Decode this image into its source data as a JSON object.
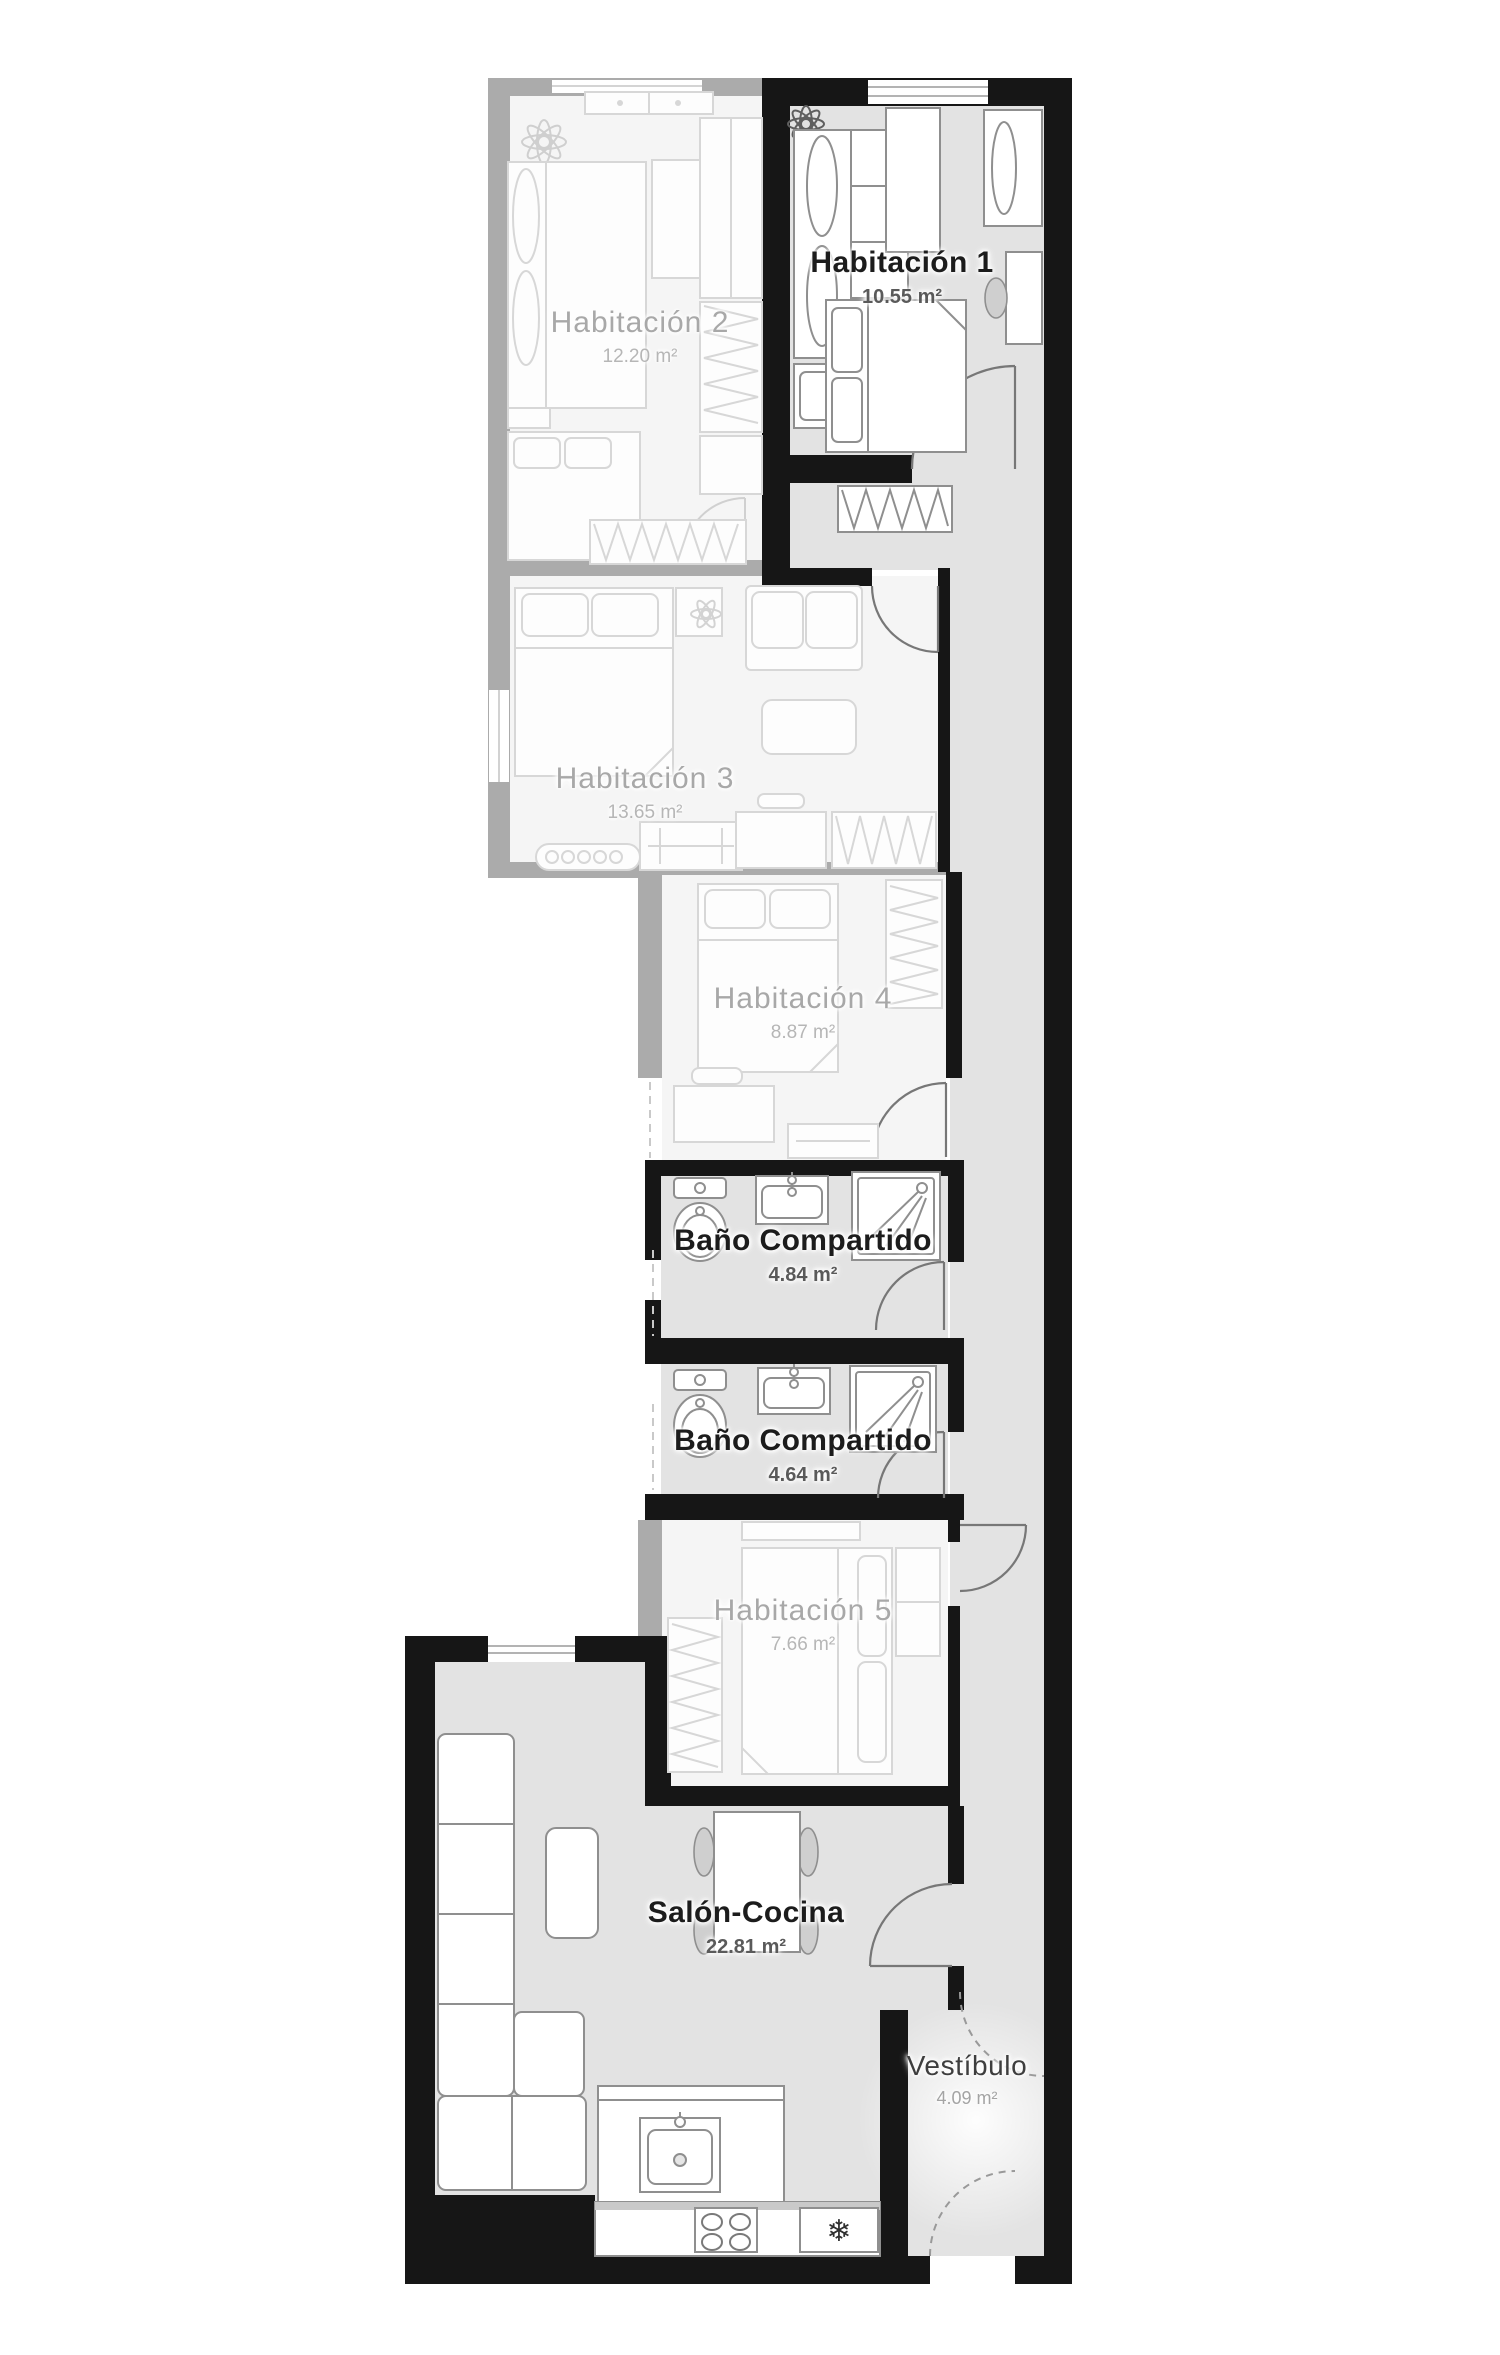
{
  "plan": {
    "rooms": [
      {
        "id": "habitacion-1",
        "name": "Habitación 1",
        "area": "10.55 m²",
        "state": "active"
      },
      {
        "id": "habitacion-2",
        "name": "Habitación 2",
        "area": "12.20 m²",
        "state": "inactive"
      },
      {
        "id": "habitacion-3",
        "name": "Habitación 3",
        "area": "13.65 m²",
        "state": "inactive"
      },
      {
        "id": "habitacion-4",
        "name": "Habitación 4",
        "area": "8.87 m²",
        "state": "inactive"
      },
      {
        "id": "bano-compartido-1",
        "name": "Baño Compartido",
        "area": "4.84 m²",
        "state": "active"
      },
      {
        "id": "bano-compartido-2",
        "name": "Baño Compartido",
        "area": "4.64 m²",
        "state": "active"
      },
      {
        "id": "habitacion-5",
        "name": "Habitación 5",
        "area": "7.66 m²",
        "state": "inactive"
      },
      {
        "id": "salon-cocina",
        "name": "Salón-Cocina",
        "area": "22.81 m²",
        "state": "active"
      },
      {
        "id": "vestibulo",
        "name": "Vestíbulo",
        "area": "4.09 m²",
        "state": "active"
      }
    ]
  },
  "icons": {
    "freezer_snowflake": "❄"
  },
  "colors": {
    "wall_active": "#161616",
    "wall_inactive": "#ababab",
    "floor_active": "#e3e3e3",
    "floor_inactive": "#f5f5f5",
    "label_active": "#1c1c1c",
    "label_inactive": "#a8a8a8",
    "area_active": "#5a5a5a",
    "area_inactive": "#b6b6b6"
  }
}
